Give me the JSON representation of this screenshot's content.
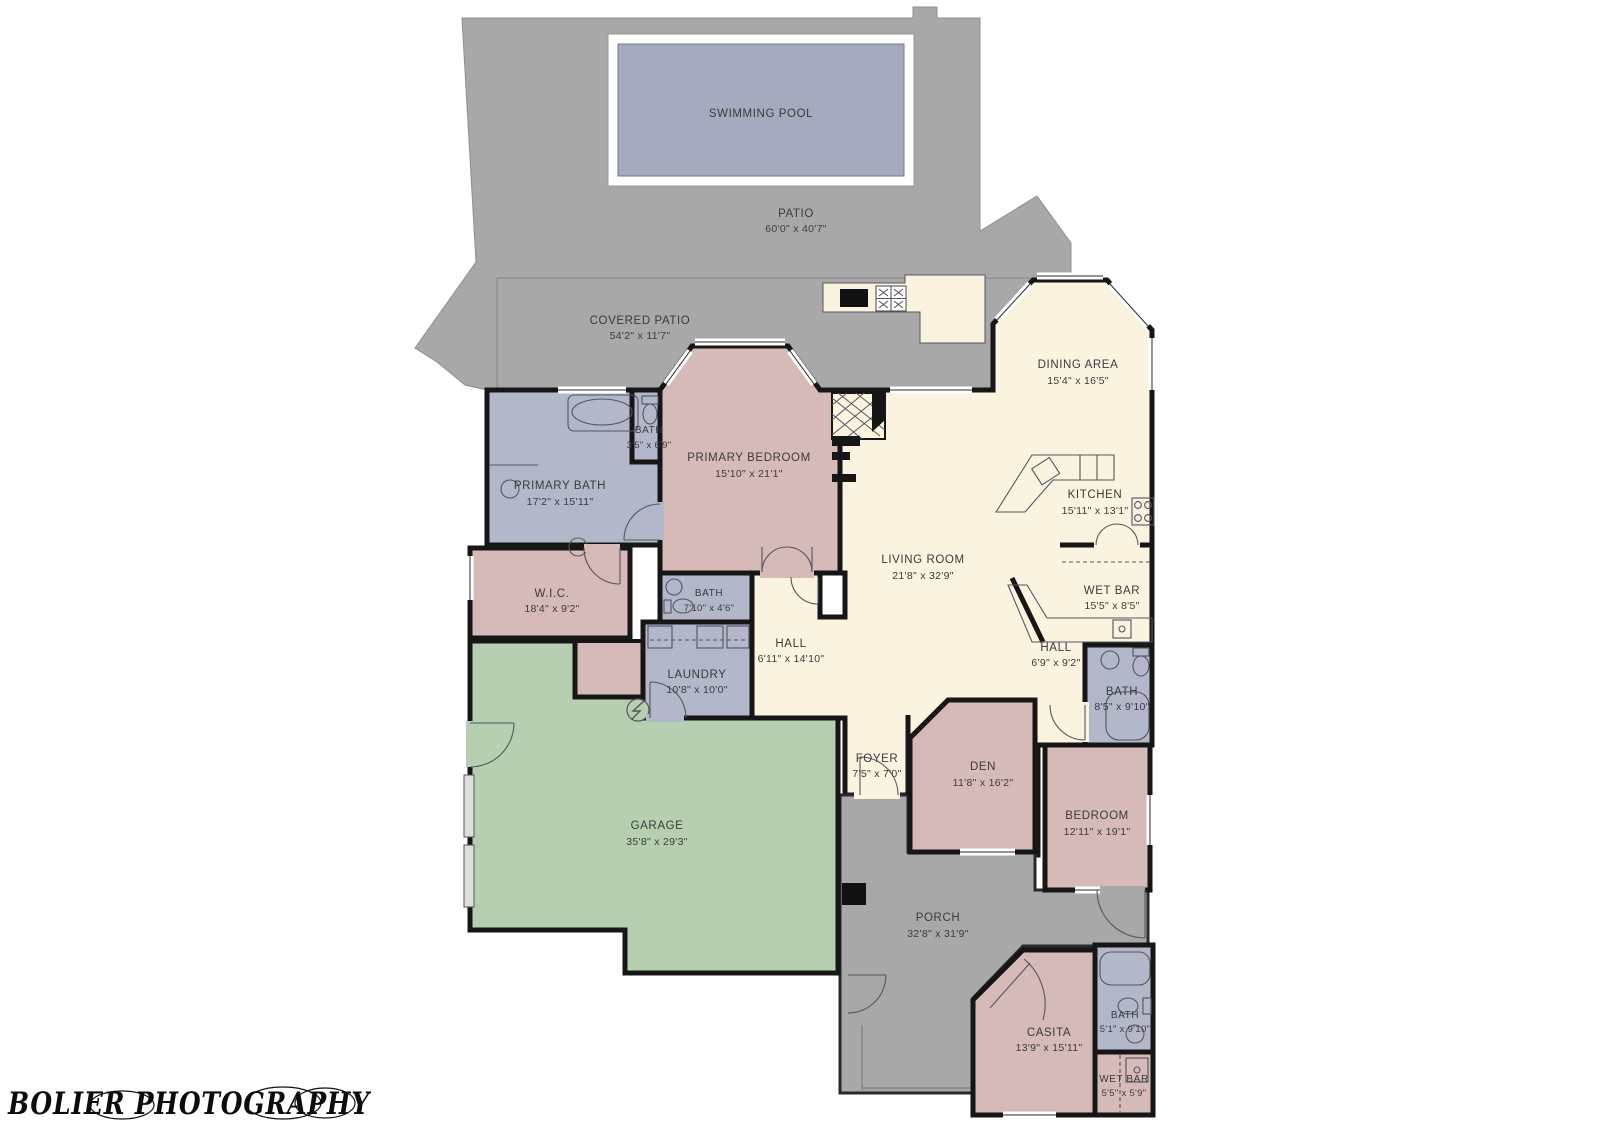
{
  "watermark": "BOLIER PHOTOGRAPHY",
  "colors": {
    "outdoor_gray": "#a8a8a8",
    "pool_water": "#a6aabf",
    "room_cream": "#faf3e0",
    "room_pink": "#d6bab7",
    "room_lavender": "#b3b7ca",
    "garage_green": "#b6cfb0",
    "wall_black": "#161616"
  },
  "rooms": [
    {
      "name": "PATIO",
      "dims": "60'0\" x 40'7\""
    },
    {
      "name": "COVERED PATIO",
      "dims": "54'2\" x 11'7\""
    },
    {
      "name": "SWIMMING POOL",
      "dims": ""
    },
    {
      "name": "DINING AREA",
      "dims": "15'4\" x 16'5\""
    },
    {
      "name": "KITCHEN",
      "dims": "15'11\" x 13'1\""
    },
    {
      "name": "PRIMARY BEDROOM",
      "dims": "15'10\" x 21'1\""
    },
    {
      "name": "BATH",
      "dims": "3'5\" x 6'9\""
    },
    {
      "name": "PRIMARY BATH",
      "dims": "17'2\" x 15'11\""
    },
    {
      "name": "LIVING ROOM",
      "dims": "21'8\" x 32'9\""
    },
    {
      "name": "WET BAR",
      "dims": "15'5\" x 8'5\""
    },
    {
      "name": "W.I.C.",
      "dims": "18'4\" x 9'2\""
    },
    {
      "name": "BATH",
      "dims": "7'10\" x 4'6\""
    },
    {
      "name": "HALL",
      "dims": "6'11\" x 14'10\""
    },
    {
      "name": "HALL",
      "dims": "6'9\" x 9'2\""
    },
    {
      "name": "LAUNDRY",
      "dims": "10'8\" x 10'0\""
    },
    {
      "name": "BATH",
      "dims": "8'5\" x 9'10\""
    },
    {
      "name": "FOYER",
      "dims": "7'5\" x 7'0\""
    },
    {
      "name": "DEN",
      "dims": "11'8\" x 16'2\""
    },
    {
      "name": "BEDROOM",
      "dims": "12'11\" x 19'1\""
    },
    {
      "name": "GARAGE",
      "dims": "35'8\" x 29'3\""
    },
    {
      "name": "PORCH",
      "dims": "32'8\" x 31'9\""
    },
    {
      "name": "CASITA",
      "dims": "13'9\" x 15'11\""
    },
    {
      "name": "BATH",
      "dims": "5'1\" x 9'10\""
    },
    {
      "name": "WET BAR",
      "dims": "5'5\" x 5'9\""
    }
  ]
}
